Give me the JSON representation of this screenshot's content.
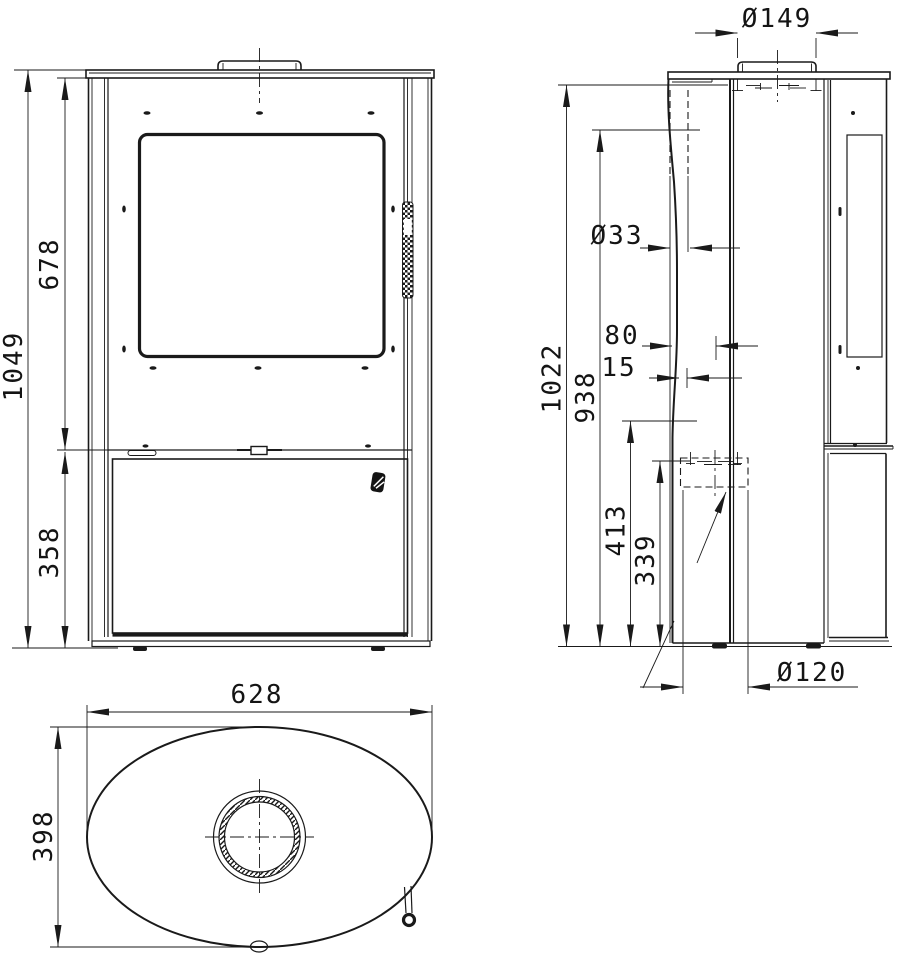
{
  "dims": {
    "front_height_total": "1049",
    "front_height_upper": "678",
    "front_height_lower": "358",
    "side_flue_diameter": "Ø149",
    "side_hole_diameter": "Ø33",
    "side_offset_rear": "80",
    "side_offset_center": "15",
    "side_height_total": "1022",
    "side_height_hole": "938",
    "side_height_outlet_top": "413",
    "side_height_outlet_center": "339",
    "side_outlet_diameter": "Ø120",
    "top_width": "628",
    "top_depth": "398"
  }
}
